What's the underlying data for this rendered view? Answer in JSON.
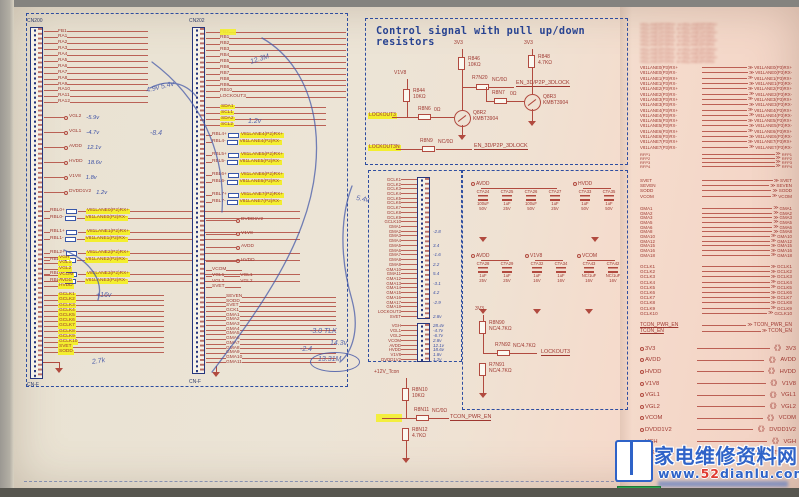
{
  "sheet": {
    "cn200_label": "CN200",
    "cn200_bottom": "CN-F",
    "cn202_label": "CN202",
    "cn202_bottom": "CN-F"
  },
  "cn200": {
    "top": [
      "FB1",
      "RA1",
      "RA2",
      "RA3",
      "RA4",
      "RA5",
      "RA6",
      "RA7",
      "RA8",
      "RA9",
      "RA10",
      "RA11",
      "RA12"
    ],
    "singles": [
      {
        "n": "VGL2",
        "v": "-5.9v"
      },
      {
        "n": "VGL1",
        "v": "-4.7v"
      },
      {
        "n": "AVDD",
        "v": "12.1v"
      },
      {
        "n": "HVDD",
        "v": "18.6v"
      },
      {
        "n": "V1V8",
        "v": "1.8v"
      },
      {
        "n": "DVDD1V2",
        "v": "1.2v"
      }
    ],
    "diff": [
      {
        "s1": "RBL0+",
        "s2": "RBL0-",
        "d1": "V81LANE0(P2)RX+",
        "d2": "V81LANE0(P2)RX-"
      },
      {
        "s1": "RBL1+",
        "s2": "RBL1-",
        "d1": "V81LANE1(P2)RX+",
        "d2": "V81LANE1(P2)RX-"
      },
      {
        "s1": "RBL2+",
        "s2": "RBL2-",
        "d1": "V81LANE2(P2)RX+",
        "d2": "V81LANE2(P2)RX-"
      },
      {
        "s1": "RBL3+",
        "s2": "RBL3-",
        "d1": "V81LANE3(P2)RX+",
        "d2": "V81LANE3(P2)RX-"
      }
    ],
    "ystack1": [
      "VGH",
      "VGL1",
      "VGL2",
      "VCOM",
      "AVDD",
      "HVDD"
    ],
    "ystack2": [
      "GCLK1",
      "GCLK2",
      "GCLK3",
      "GCLK4",
      "GCLK5",
      "GCLK6",
      "GCLK7",
      "GCLK8",
      "GCLK9",
      "GCLK10",
      "SVET",
      "SODD"
    ]
  },
  "cn202": {
    "top": [
      "FB2",
      "RB1",
      "RB2",
      "RB3",
      "RB4",
      "RB5",
      "RB6",
      "RB7",
      "RB8",
      "RB9",
      "RB10",
      "LOCKOUT3"
    ],
    "ystacka": [
      "SDA1",
      "SCL1",
      "SDA2",
      "SCL2"
    ],
    "diff": [
      {
        "s1": "RBL4+",
        "s2": "RBL4-",
        "d1": "V81LANE4(P2)RX+",
        "d2": "V81LANE4(P2)RX-"
      },
      {
        "s1": "RBL5+",
        "s2": "RBL5-",
        "d1": "V81LANE5(P2)RX+",
        "d2": "V81LANE5(P2)RX-"
      },
      {
        "s1": "RBL6+",
        "s2": "RBL6-",
        "d1": "V81LANE6(P2)RX+",
        "d2": "V81LANE6(P2)RX-"
      },
      {
        "s1": "RBL7+",
        "s2": "RBL7-",
        "d1": "V81LANE7(P2)RX+",
        "d2": "V81LANE7(P2)RX-"
      }
    ],
    "singles": [
      {
        "n": "DVDD1V2"
      },
      {
        "n": "V1V8"
      },
      {
        "n": "AVDD"
      },
      {
        "n": "HVDD"
      }
    ],
    "vcom": [
      {
        "t": "VCOM",
        "d": ""
      },
      {
        "t": "VGL1",
        "d": "VGL1"
      },
      {
        "t": "VGL2",
        "d": "VGL2"
      },
      {
        "t": "SVET",
        "d": ""
      }
    ],
    "long": [
      "SEVEN",
      "SODD",
      "SVET",
      "GCK1",
      "GMA1",
      "GMA2",
      "GMA3",
      "GMA4",
      "GMA5",
      "GMA6",
      "GMA7",
      "GMA8",
      "GMA9",
      "GMA10",
      "GMA11"
    ]
  },
  "control": {
    "title": "Control signal with pull up/down resistors",
    "net_v1v8": "V1V8",
    "net_3v3_a": "3V3",
    "net_3v3_b": "3V3",
    "r844": "R844\n10KΩ",
    "r846": "R846\n10KΩ",
    "r848": "R848\n4.7KΩ",
    "r8n6": "R8N6",
    "r8n6_val": "0Ω",
    "r8n7": "R8N7",
    "r8n7_val": "0Ω",
    "r7n20": "R7N20",
    "r7n20_val": "NC/0Ω",
    "r8n9": "R8N9",
    "r8n9_val": "NC/0Ω",
    "q8r2": "Q8R2\nKMBT3904",
    "q8r3": "Q8R3\nKMBT3904",
    "lockout_in": "LOCKOUT3",
    "lockout_n": "LOCKOUT3N",
    "en_a": "EN_3D/P2P_3DLOCK",
    "en_b": "EN_3D/P2P_3DLOCK"
  },
  "tconn": {
    "strip1": [
      {
        "n": "GCLK1",
        "v": ""
      },
      {
        "n": "GCLK2",
        "v": ""
      },
      {
        "n": "GCLK3",
        "v": ""
      },
      {
        "n": "GCLK4",
        "v": ""
      },
      {
        "n": "GCLK5",
        "v": ""
      },
      {
        "n": "GCLK6",
        "v": ""
      },
      {
        "n": "GCLK7",
        "v": ""
      },
      {
        "n": "GCLK8",
        "v": ""
      },
      {
        "n": "GCLK9",
        "v": ""
      },
      {
        "n": "GCLK10",
        "v": ""
      },
      {
        "n": "GMA1",
        "v": ""
      },
      {
        "n": "GMA2",
        "v": "-2.8"
      },
      {
        "n": "GMA3",
        "v": ""
      },
      {
        "n": "GMA4",
        "v": ""
      },
      {
        "n": "GMA5",
        "v": "3.4"
      },
      {
        "n": "GMA6",
        "v": ""
      },
      {
        "n": "GMA7",
        "v": "-1.6"
      },
      {
        "n": "GMA8",
        "v": ""
      },
      {
        "n": "GMA9",
        "v": "2.2"
      },
      {
        "n": "GMA10",
        "v": ""
      },
      {
        "n": "GMA11",
        "v": "5.4"
      },
      {
        "n": "GMA12",
        "v": ""
      },
      {
        "n": "GMA13",
        "v": "-3.1"
      },
      {
        "n": "GMA14",
        "v": ""
      },
      {
        "n": "GMA15",
        "v": "4.2"
      },
      {
        "n": "GMA16",
        "v": ""
      },
      {
        "n": "GMA17",
        "v": "-2.9"
      },
      {
        "n": "GMA18",
        "v": ""
      },
      {
        "n": "LOCKOUT3",
        "v": ""
      },
      {
        "n": "SVET",
        "v": "2.8v"
      }
    ],
    "strip2": [
      {
        "n": "VGH",
        "v": "28.4v"
      },
      {
        "n": "VGL1",
        "v": "-4.7v"
      },
      {
        "n": "VGL2",
        "v": "-6.7v"
      },
      {
        "n": "VCOM",
        "v": "2.8v"
      },
      {
        "n": "AVDD",
        "v": "12.1v"
      },
      {
        "n": "HVDD",
        "v": "18.6v"
      },
      {
        "n": "V1V8",
        "v": "1.8v"
      },
      {
        "n": "DVDD1V2",
        "v": "1.2v"
      }
    ]
  },
  "caps": {
    "g1": {
      "net": "AVDD",
      "caps": [
        {
          "r": "CTA24",
          "c": "100uF",
          "v": "50V"
        },
        {
          "r": "CTA25",
          "c": "1uF",
          "v": "25V"
        },
        {
          "r": "CTA26",
          "c": "100uF",
          "v": "50V"
        },
        {
          "r": "CTA27",
          "c": "1uF",
          "v": "25V"
        }
      ]
    },
    "g2": {
      "net": "HVDD",
      "caps": [
        {
          "r": "CTA33",
          "c": "1uF",
          "v": "50V"
        },
        {
          "r": "CTA35",
          "c": "1uF",
          "v": "50V"
        }
      ]
    },
    "g3": {
      "net": "AVDD",
      "caps": [
        {
          "r": "CTA28",
          "c": "1uF",
          "v": "25V"
        },
        {
          "r": "CTA29",
          "c": "1uF",
          "v": "25V"
        }
      ]
    },
    "g4": {
      "net": "V1V8",
      "caps": [
        {
          "r": "CTA32",
          "c": "1uF",
          "v": "16V"
        },
        {
          "r": "CTA34",
          "c": "1uF",
          "v": "16V"
        }
      ]
    },
    "g5": {
      "net": "VCOM",
      "caps": [
        {
          "r": "CTA43",
          "c": "NC/1uF",
          "v": "16V"
        },
        {
          "r": "CTA42",
          "c": "NC/1uF",
          "v": "16V"
        }
      ]
    }
  },
  "pullup": {
    "net": "3V3",
    "r_top": "R8N90\nNC/4.7KΩ",
    "r_mid": "R7N92",
    "r_mid_val": "NC/4.7KΩ",
    "r_bot": "R7N91\nNC/4.7KΩ",
    "dest": "LOCKOUT3"
  },
  "pwr12": {
    "net": "+12V_Tcon",
    "r_top": "R8N10\n10KΩ",
    "r_mid": "R8N11",
    "r_mid_val": "NC/0Ω",
    "r_bot": "R8N12\n4.7KΩ",
    "dest": "TCON_PWR_EN"
  },
  "right": {
    "blur": [
      "V81LANE0(P3)RX+ ≫V81LANE0(P3)RX+",
      "V81LANE0(P3)RX- ≫V81LANE0(P3)RX-",
      "V81LANE1(P3)RX+ ≫V81LANE1(P3)RX+",
      "V81LANE1(P3)RX- ≫V81LANE1(P3)RX-",
      "V81LANE2(P3)RX+ ≫V81LANE2(P3)RX+",
      "V81LANE2(P3)RX- ≫V81LANE2(P3)RX-",
      "V81LANE3(P3)RX+ ≫V81LANE3(P3)RX+",
      "V81LANE3(P3)RX- ≫V81LANE3(P3)RX-",
      "V81LANE4(P3)RX+ ≫V81LANE4(P3)RX+",
      "V81LANE4(P3)RX- ≫V81LANE4(P3)RX-"
    ],
    "lanes": [
      {
        "n": "V81LANE0(P3)RX+"
      },
      {
        "n": "V81LANE0(P3)RX-"
      },
      {
        "n": "V81LANE1(P3)RX+"
      },
      {
        "n": "V81LANE1(P3)RX-"
      },
      {
        "n": "V81LANE2(P3)RX+"
      },
      {
        "n": "V81LANE2(P3)RX-"
      },
      {
        "n": "V81LANE3(P3)RX+"
      },
      {
        "n": "V81LANE3(P3)RX-"
      },
      {
        "n": "V81LANE4(P3)RX+"
      },
      {
        "n": "V81LANE4(P3)RX-"
      },
      {
        "n": "V81LANE5(P3)RX+"
      },
      {
        "n": "V81LANE5(P3)RX-"
      },
      {
        "n": "V81LANE6(P3)RX+"
      },
      {
        "n": "V81LANE6(P3)RX-"
      },
      {
        "n": "V81LANE7(P3)RX+"
      },
      {
        "n": "V81LANE7(P3)RX-"
      }
    ],
    "rfp": [
      {
        "n": "RFP1"
      },
      {
        "n": "RFP2"
      },
      {
        "n": "RFP3"
      },
      {
        "n": "RFP4"
      }
    ],
    "ctrl": [
      {
        "n": "SVET"
      },
      {
        "n": "SEVEN"
      },
      {
        "n": "SODD"
      },
      {
        "n": "VCOM"
      }
    ],
    "gma": [
      {
        "n": "GMA1"
      },
      {
        "n": "GMA2"
      },
      {
        "n": "GMA3"
      },
      {
        "n": "GMA5"
      },
      {
        "n": "GMA6"
      },
      {
        "n": "GMA8"
      },
      {
        "n": "GMA10"
      },
      {
        "n": "GMA12"
      },
      {
        "n": "GMA15"
      },
      {
        "n": "GMA16"
      },
      {
        "n": "GMA18"
      }
    ],
    "gclk": [
      {
        "n": "GCLK1"
      },
      {
        "n": "GCLK2"
      },
      {
        "n": "GCLK3"
      },
      {
        "n": "GCLK4"
      },
      {
        "n": "GCLK5"
      },
      {
        "n": "GCLK6"
      },
      {
        "n": "GCLK7"
      },
      {
        "n": "GCLK8"
      },
      {
        "n": "GCLK9"
      },
      {
        "n": "GCLK10"
      }
    ],
    "tcon": [
      {
        "n": "TCON_PWR_EN"
      },
      {
        "n": "TCON_EN"
      }
    ],
    "power": [
      {
        "n": "3V3"
      },
      {
        "n": "AVDD"
      },
      {
        "n": "HVDD"
      },
      {
        "n": "V1V8"
      },
      {
        "n": "VGL1"
      },
      {
        "n": "VGL2"
      },
      {
        "n": "VCOM"
      },
      {
        "n": "DVDD1V2"
      },
      {
        "n": "VGH"
      },
      {
        "n": "+12V_Tcon"
      }
    ]
  },
  "annotations": [
    {
      "t": "4.9v  5.4v",
      "style": "left:146px;top:84px;transform:rotate(-14deg)"
    },
    {
      "t": "12.3M",
      "style": "left:250px;top:56px;transform:rotate(-18deg)"
    },
    {
      "t": "1.2v",
      "style": "left:248px;top:118px"
    },
    {
      "t": "-8.4",
      "style": "left:150px;top:130px"
    },
    {
      "t": "+16v",
      "style": "left:96px;top:292px"
    },
    {
      "t": "2.7k",
      "style": "left:92px;top:358px;transform:rotate(-8deg)"
    },
    {
      "t": "5.4v",
      "style": "left:356px;top:196px;transform:rotate(10deg)"
    },
    {
      "t": "-3.0  TLK",
      "style": "left:310px;top:328px"
    },
    {
      "t": "-2.4",
      "style": "left:300px;top:346px"
    },
    {
      "t": "14.3v",
      "style": "left:330px;top:340px"
    },
    {
      "t": "13.31M",
      "style": "left:318px;top:356px"
    }
  ],
  "watermark": {
    "site_name": "家电维修资料网",
    "url_prefix": "www.",
    "url_highlight": "52",
    "url_suffix": "dianlu.com"
  }
}
